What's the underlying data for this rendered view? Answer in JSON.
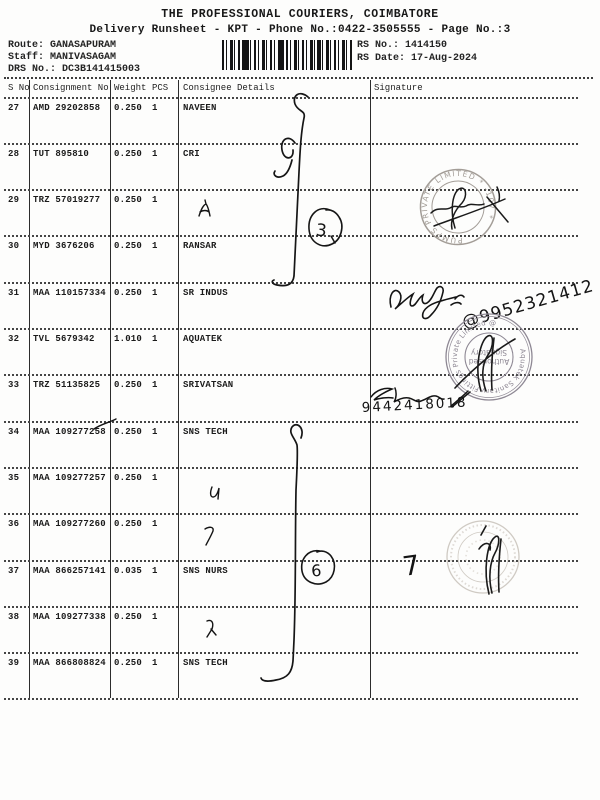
{
  "doc": {
    "title": "THE PROFESSIONAL COURIERS, COIMBATORE",
    "subtitle": "Delivery Runsheet - KPT - Phone No.:0422-3505555 - Page No.:3",
    "route_label": "Route: ",
    "route_value": "GANASAPURAM",
    "staff_label": "Staff: ",
    "staff_value": "MANIVASAGAM",
    "drs_label": "DRS No.: ",
    "drs_value": "DC3B141415003",
    "rs_no_label": "RS No.: ",
    "rs_no_value": "1414150",
    "rs_date_label": "RS Date: ",
    "rs_date_value": "17-Aug-2024"
  },
  "table": {
    "headers": {
      "sno": "S No",
      "consignment": "Consignment No",
      "weight": "Weight",
      "pcs": "PCS",
      "consignee": "Consignee Details",
      "signature": "Signature"
    },
    "rows": [
      {
        "sno": "27",
        "consignment": "AMD 29202858",
        "weight": "0.250",
        "pcs": "1",
        "consignee": "NAVEEN"
      },
      {
        "sno": "28",
        "consignment": "TUT 895810",
        "weight": "0.250",
        "pcs": "1",
        "consignee": "CRI"
      },
      {
        "sno": "29",
        "consignment": "TRZ 57019277",
        "weight": "0.250",
        "pcs": "1",
        "consignee": ""
      },
      {
        "sno": "30",
        "consignment": "MYD 3676206",
        "weight": "0.250",
        "pcs": "1",
        "consignee": "RANSAR"
      },
      {
        "sno": "31",
        "consignment": "MAA 110157334",
        "weight": "0.250",
        "pcs": "1",
        "consignee": "SR INDUS"
      },
      {
        "sno": "32",
        "consignment": "TVL 5679342",
        "weight": "1.010",
        "pcs": "1",
        "consignee": "AQUATEK"
      },
      {
        "sno": "33",
        "consignment": "TRZ 51135825",
        "weight": "0.250",
        "pcs": "1",
        "consignee": "SRIVATSAN"
      },
      {
        "sno": "34",
        "consignment": "MAA 109277258",
        "weight": "0.250",
        "pcs": "1",
        "consignee": "SNS TECH"
      },
      {
        "sno": "35",
        "consignment": "MAA 109277257",
        "weight": "0.250",
        "pcs": "1",
        "consignee": ""
      },
      {
        "sno": "36",
        "consignment": "MAA 109277260",
        "weight": "0.250",
        "pcs": "1",
        "consignee": ""
      },
      {
        "sno": "37",
        "consignment": "MAA 866257141",
        "weight": "0.035",
        "pcs": "1",
        "consignee": "SNS NURS"
      },
      {
        "sno": "38",
        "consignment": "MAA 109277338",
        "weight": "0.250",
        "pcs": "1",
        "consignee": ""
      },
      {
        "sno": "39",
        "consignment": "MAA 866808824",
        "weight": "0.250",
        "pcs": "1",
        "consignee": "SNS TECH"
      }
    ]
  },
  "annotations": {
    "circled_3": "3",
    "circled_6": "6",
    "mark_7": "7",
    "phone_1": "@9952321412",
    "phone_2": "9442418018",
    "stamp1": {
      "rim": "PUMPS PRIVATE LIMITED * -107 *"
    },
    "stamp2": {
      "rim": "Aquatek Sanitary Fittings Private Limited @",
      "inner_1": "Authorised",
      "inner_2": "Signatory"
    }
  }
}
